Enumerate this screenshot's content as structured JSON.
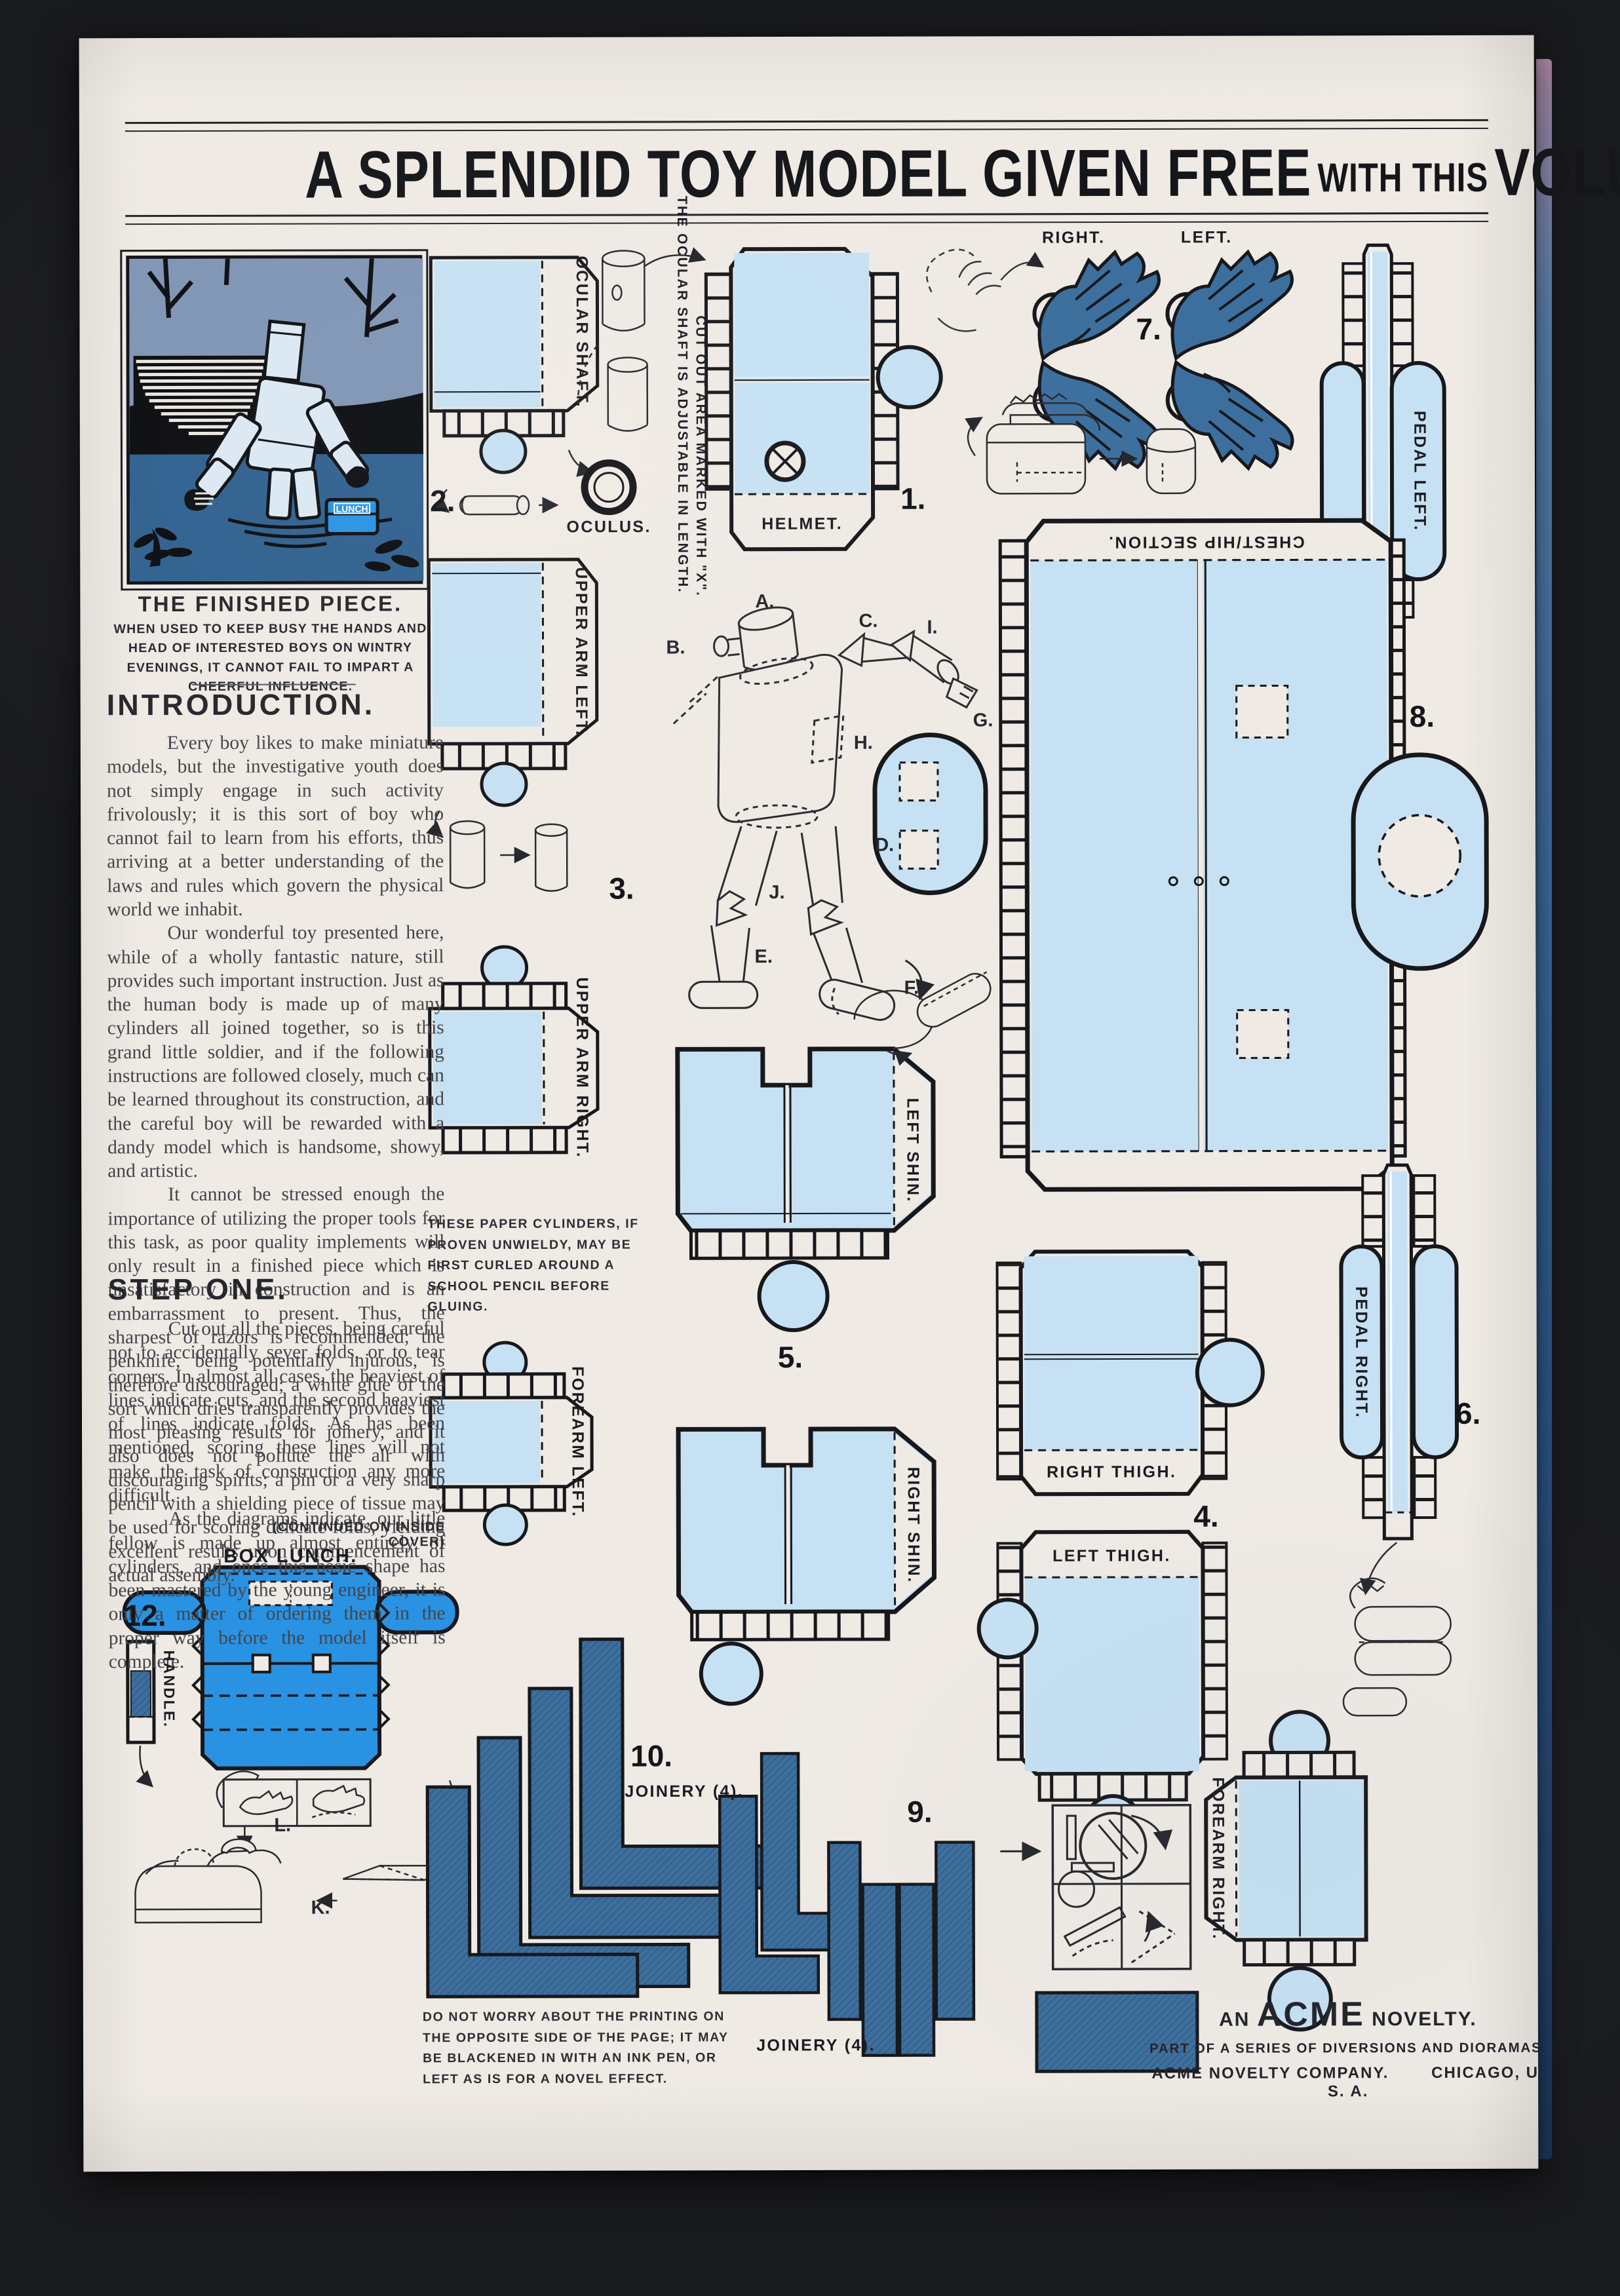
{
  "title": {
    "main1": "A SPLENDID TOY MODEL GIVEN FREE",
    "small": "WITH THIS",
    "main2": "VOLUME."
  },
  "finished": {
    "heading": "THE FINISHED PIECE.",
    "caption": "WHEN USED TO KEEP BUSY THE HANDS AND HEAD OF INTERESTED BOYS ON WINTRY EVENINGS, IT CANNOT FAIL TO IMPART A CHEERFUL INFLUENCE."
  },
  "introduction": {
    "heading": "INTRODUCTION.",
    "p1": "Every boy likes to make miniature models, but the investigative youth does not simply engage in such activity frivolously; it is this sort of boy who cannot fail to learn from his efforts, thus arriving at a better understanding of the laws and rules which govern the physical world we inhabit.",
    "p2": "Our wonderful toy presented here, while of a wholly fantastic nature, still provides such important instruction. Just as the human body is made up of many cylinders all joined together, so is this grand little soldier, and if the following instructions are followed closely, much can be learned throughout its construction, and the careful boy will be rewarded with a dandy model which is handsome, showy, and artistic.",
    "p3": "It cannot be stressed enough the importance of utilizing the proper tools for this task, as poor quality implements will only result in a finished piece which is unsatisfactory in construction and is an embarrassment to present. Thus, the sharpest of razors is recommended; the penknife, being potentially injurous, is therefore discouraged; a white glue of the sort which dries transparently provides the most pleasing results for joinery, and it also does not pollute the air with discouraging spirits; a pin or a very sharp pencil with a shielding piece of tissue may be used for scoring delicate folds, yielding excellent results upon commencement of actual assembly."
  },
  "step_one": {
    "heading": "STEP ONE.",
    "p1": "Cut out all the pieces, being careful not to accidentally sever folds, or to tear corners.  In almost all cases, the heaviest of lines indicate cuts, and the second heaviest of lines indicate folds.  As has been mentioned, scoring these lines will not make the task of construction any more difficult.",
    "p2": "As the diagrams indicate, our little fellow is made up almost entirely of cylinders, and once this basic shape has been mastered by the young engineer, it is only a matter of ordering them in the proper way  before the model itself is complete.",
    "continued": "(CONTINUED ON INSIDE COVER)"
  },
  "notes": {
    "ocular_adjustable": "THE OCULAR SHAFT IS ADJUSTABLE IN LENGTH.",
    "cut_x": "CUT OUT AREA MARKED WITH \"X\".",
    "cylinders": "THESE PAPER CYLINDERS, IF PROVEN UNWIELDY, MAY BE FIRST CURLED AROUND A SCHOOL PENCIL BEFORE GLUING.",
    "printing": "DO NOT WORRY ABOUT THE PRINTING ON THE OPPOSITE SIDE OF THE PAGE; IT MAY BE BLACKENED IN WITH AN INK PEN, OR LEFT AS IS FOR A NOVEL EFFECT."
  },
  "parts": {
    "ocular_shaft": "OCULAR SHAFT.",
    "oculus": "OCULUS.",
    "helmet": "HELMET.",
    "upper_arm_left": "UPPER ARM LEFT.",
    "upper_arm_right": "UPPER ARM RIGHT.",
    "forearm_left": "FOREARM LEFT.",
    "forearm_right": "FOREARM RIGHT.",
    "left_shin": "LEFT SHIN.",
    "right_shin": "RIGHT SHIN.",
    "right_thigh": "RIGHT THIGH.",
    "left_thigh": "LEFT THIGH.",
    "chest": "CHEST/HIP SECTION.",
    "pedal_left": "PEDAL LEFT.",
    "pedal_right": "PEDAL RIGHT.",
    "box_lunch": "BOX LUNCH.",
    "handle": "HANDLE.",
    "joinery": "JOINERY (4).",
    "glove_right": "RIGHT.",
    "glove_left": "LEFT."
  },
  "numbers": {
    "n1": "1.",
    "n2": "2.",
    "n3": "3.",
    "n4": "4.",
    "n5": "5.",
    "n6": "6.",
    "n7": "7.",
    "n8": "8.",
    "n9": "9.",
    "n10": "10.",
    "n12": "12."
  },
  "letters": {
    "a": "A.",
    "b": "B.",
    "c": "C.",
    "d": "D.",
    "e": "E.",
    "f": "F.",
    "g": "G.",
    "h": "H.",
    "i": "I.",
    "j": "J.",
    "k": "K.",
    "l": "L."
  },
  "illustration": {
    "lunch_label": "LUNCH"
  },
  "footer": {
    "an": "AN",
    "acme": "ACME",
    "novelty": "NOVELTY.",
    "series": "PART OF A SERIES OF DIVERSIONS AND DIORAMAS.",
    "company": "ACME NOVELTY COMPANY.",
    "city": "CHICAGO, U. S. A."
  },
  "colors": {
    "paper": "#efeae4",
    "light_blue": "#c6e1f3",
    "bright_blue": "#2a92e2",
    "steel_blue": "#3d6f9e",
    "water_navy": "#30618f",
    "sky": "#8095b5",
    "ink": "#17181c"
  }
}
